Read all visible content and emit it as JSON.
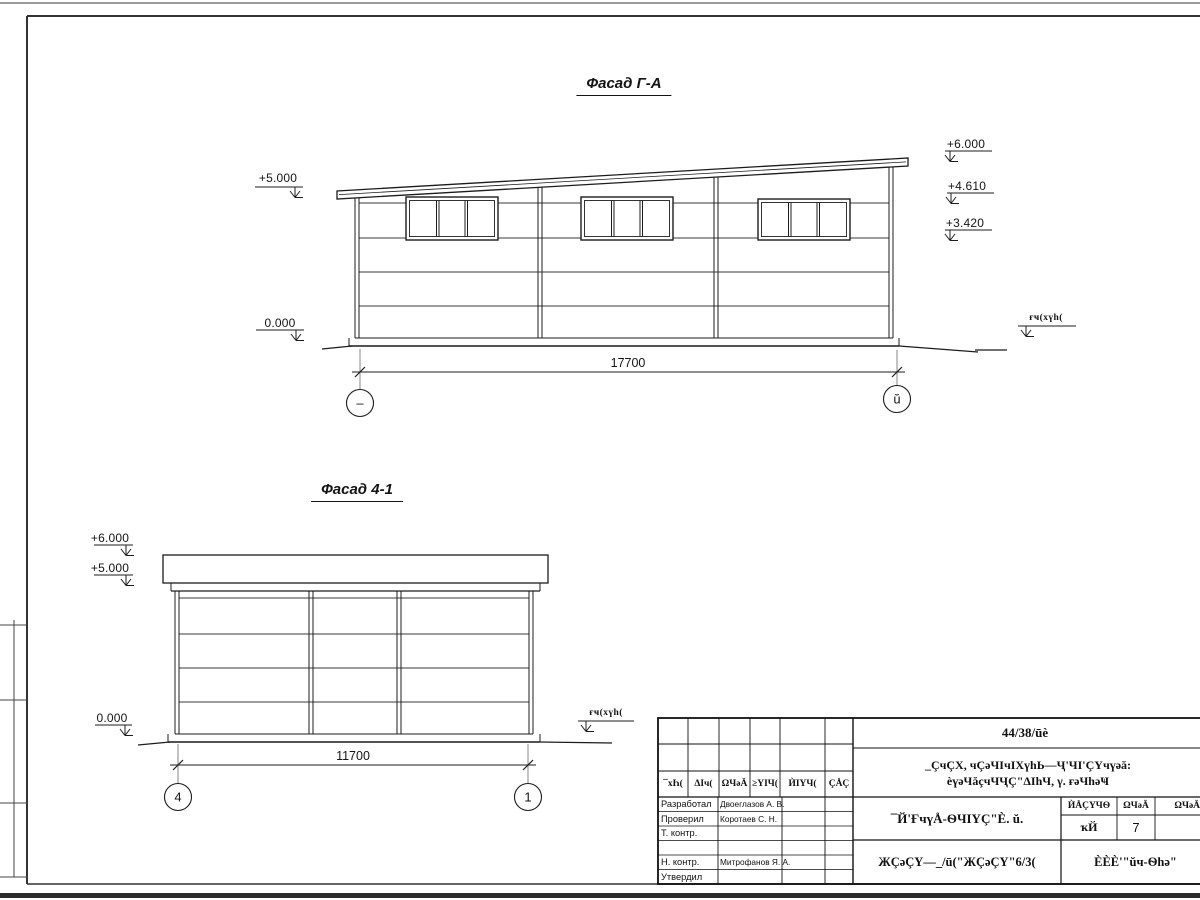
{
  "colors": {
    "line": "#1c1c1c",
    "paper": "#ffffff"
  },
  "facade_top": {
    "title": "Фасад Г-А",
    "dimension_label": "17700",
    "axis_left_label": "–",
    "axis_right_label": "ŭ",
    "elev_left_upper": "+5.000",
    "elev_left_zero": "0.000",
    "elev_right_1": "+6.000",
    "elev_right_2": "+4.610",
    "elev_right_3": "+3.420",
    "ground_level_label": "ғҹ(хүh("
  },
  "facade_bottom": {
    "title": "Фасад 4-1",
    "dimension_label": "11700",
    "axis_left_label": "4",
    "axis_right_label": "1",
    "elev_left_1": "+6.000",
    "elev_left_2": "+5.000",
    "elev_left_zero": "0.000",
    "ground_level_label": "ғҹ(хүh("
  },
  "title_block": {
    "doc_number": "44/38/ūè",
    "project_line1": "_ÇчÇХ, чÇәЧΙчΙХүhЬ—Ҷ'ЧΙ'ÇҮчүәă:",
    "project_line2": "èүәЧăçчЧҶÇ\"ΔΙһЧ, γ. ғәЧһәҸ",
    "col_headers": [
      "¯хҺ(",
      "ΔΙч(",
      "ΩЧәĂ",
      "≥ΥΙЧ(",
      "ЍΙΥЧ(",
      "ÇÅÇ"
    ],
    "rows": [
      {
        "role": "Разработал",
        "name": "Двоеглазов А. В."
      },
      {
        "role": "Проверил",
        "name": "Коротаев С. Н."
      },
      {
        "role": "Т. контр.",
        "name": ""
      },
      {
        "role": "",
        "name": ""
      },
      {
        "role": "Н. контр.",
        "name": "Митрофанов Я. А."
      },
      {
        "role": "Утвердил",
        "name": ""
      }
    ],
    "object_name": "¯Й'ҒчүÅ-ѲЧΙΥÇ\"È. ŭ.",
    "sheet_code": "ЖÇәÇΥ—_/ū(\"ЖÇәÇΥ\"6/3(",
    "company": "ÈÈÈ'\"ŭч-Ѳһә\"",
    "stage_col_header": "ЍÅÇΥЧѲ",
    "sheet_col_header": "ΩЧәĂ",
    "sheets_col_header": "ΩЧәĂIΥ",
    "stage_value": "ҡЙ",
    "sheet_value": "7"
  }
}
